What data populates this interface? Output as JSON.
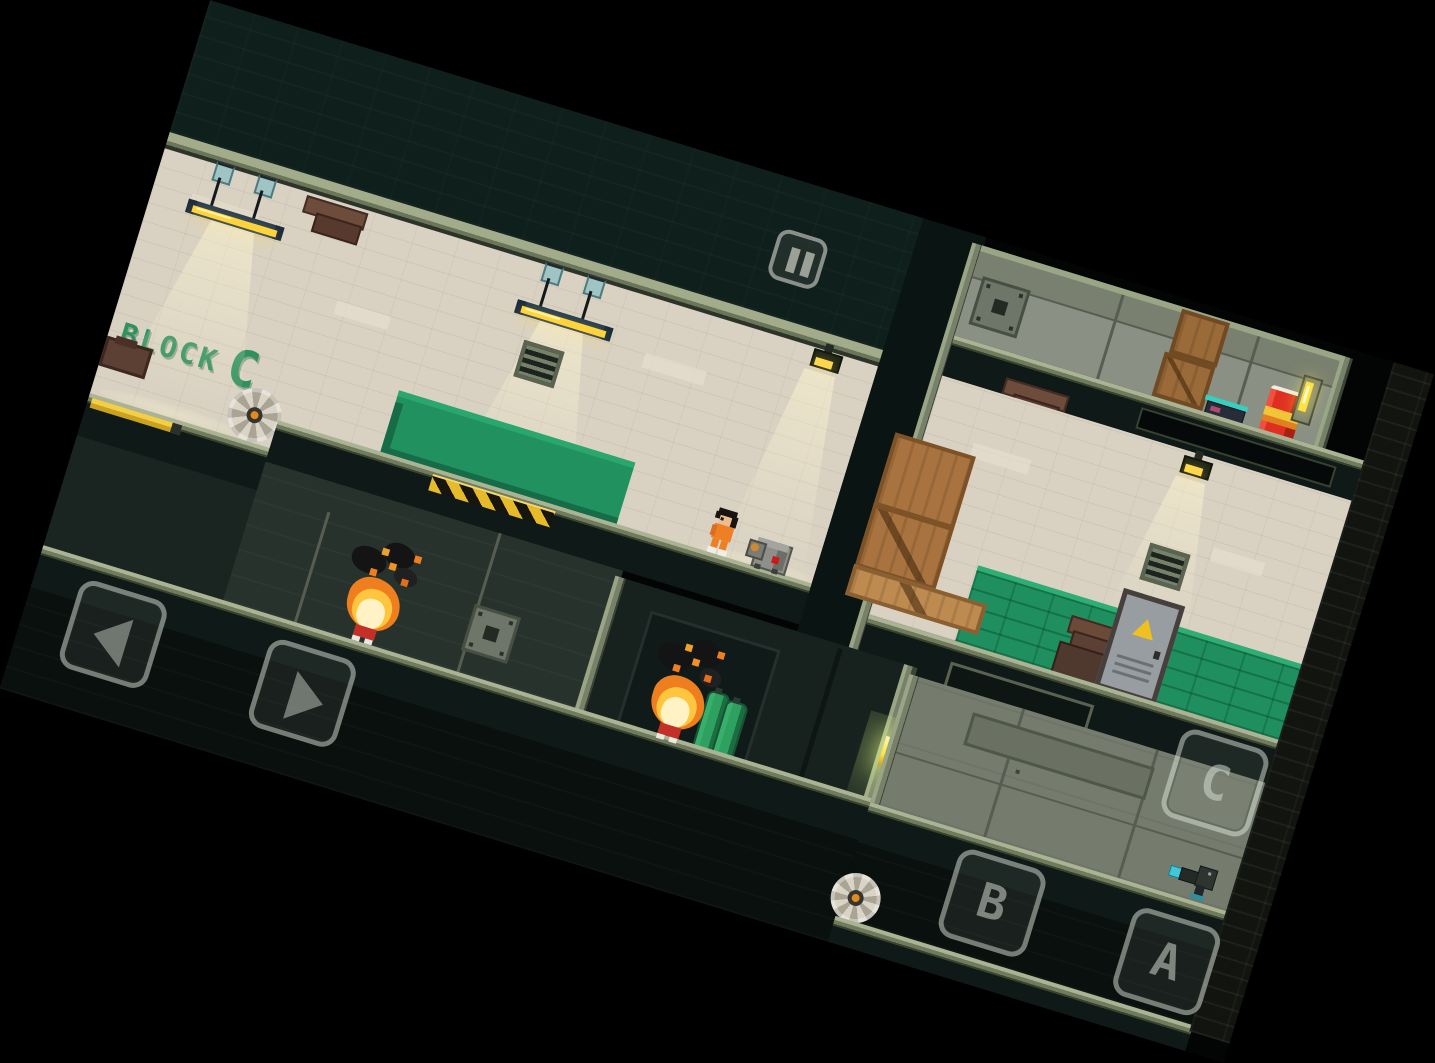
{
  "sign": {
    "block": "BLOCK",
    "letter": "C"
  },
  "hud": {
    "pause_icon": "pause-icon",
    "dpad": {
      "left_icon": "arrow-left-icon",
      "right_icon": "arrow-right-icon"
    },
    "buttons": {
      "c": "C",
      "b": "B",
      "a": "A"
    }
  },
  "level": {
    "sign_text": "BLOCK C",
    "entities": [
      "prisoner",
      "burning-guard",
      "burning-guard",
      "proximity-mine",
      "gas-canisters",
      "saw-blade",
      "saw-blade",
      "saw-blade",
      "ceiling-lamp",
      "ceiling-lamp",
      "wall-lamp",
      "wall-lamp",
      "air-vent",
      "air-vent",
      "wooden-crate-stack",
      "wooden-crate-stack",
      "red-barrel",
      "gun-pickup",
      "gun-pickup",
      "metal-door",
      "green-canopy",
      "wall-switch",
      "service-hatch",
      "service-hatch"
    ]
  },
  "colors": {
    "background": "#000000",
    "ceiling": "#0e1f1c",
    "wall_beige": "#d9d2c3",
    "beam_sage": "#97a281",
    "green_accent": "#1f8f5f",
    "sign_green": "#2f9160",
    "hazard_yellow": "#e7ba29",
    "barrel_red": "#df2f20",
    "flame_orange": "#ef7f1e",
    "lamp_yellow": "#ffd73e",
    "jumpsuit_orange": "#ef7f25",
    "hud_border": "rgba(222,228,220,0.5)"
  }
}
